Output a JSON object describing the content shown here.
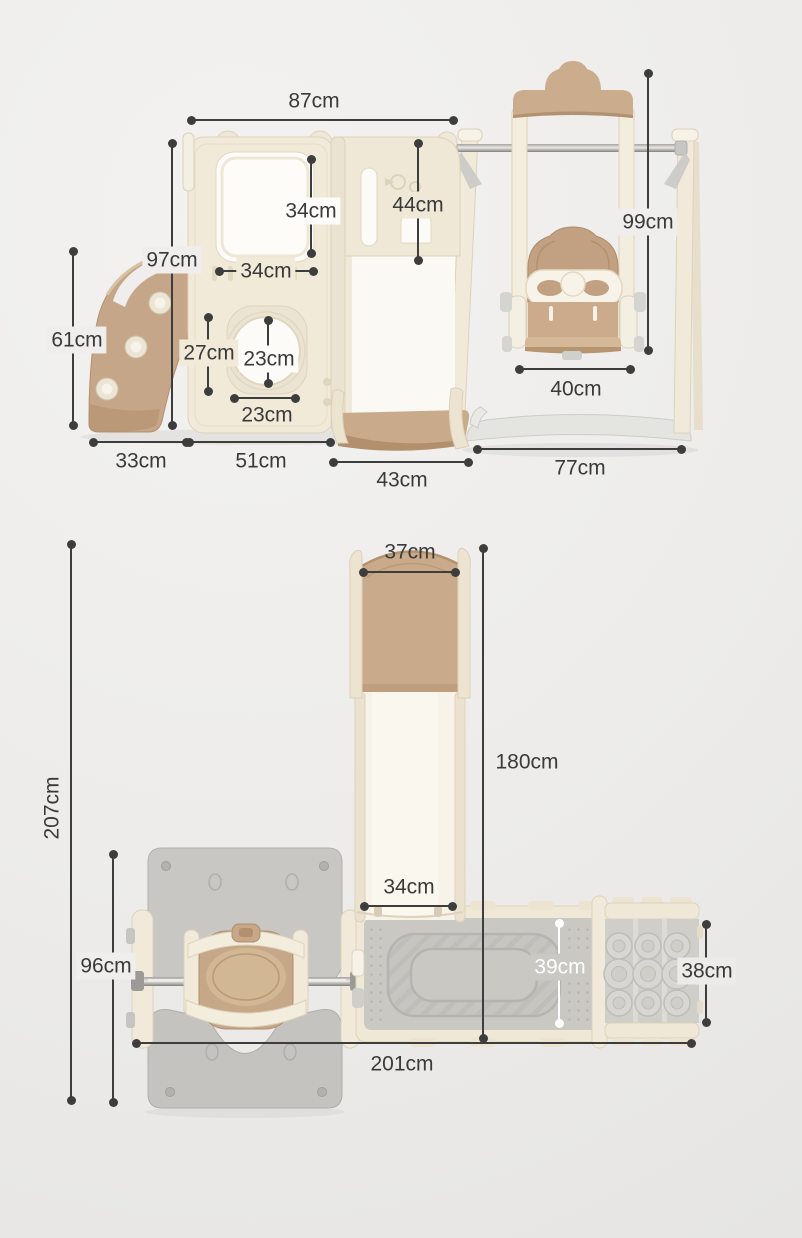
{
  "product": {
    "type": "kids-slide-swing-playset-dimension-diagram",
    "views": {
      "front": "front-view",
      "top": "top-view"
    }
  },
  "colors": {
    "background": "#efeeec",
    "cream": "#f1ead9",
    "tan": "#c7a98a",
    "gray_mat": "#c9c8c3",
    "gray_plate": "#c6c5c1",
    "dimension_line": "#3d3d3d",
    "dimension_line_white": "#ffffff",
    "text": "#3a3a3a"
  },
  "front_view": {
    "dimensions": [
      {
        "id": "house-top-width",
        "label": "87cm"
      },
      {
        "id": "house-height",
        "label": "97cm"
      },
      {
        "id": "slide-height",
        "label": "61cm"
      },
      {
        "id": "window-width",
        "label": "34cm"
      },
      {
        "id": "window-height",
        "label": "34cm"
      },
      {
        "id": "mid-panel-height",
        "label": "44cm"
      },
      {
        "id": "hole-top-offset",
        "label": "27cm"
      },
      {
        "id": "hole-height",
        "label": "23cm"
      },
      {
        "id": "hole-width",
        "label": "23cm"
      },
      {
        "id": "swing-height",
        "label": "99cm"
      },
      {
        "id": "swing-seat-width",
        "label": "40cm"
      },
      {
        "id": "slide-base-width",
        "label": "33cm"
      },
      {
        "id": "house-base-width",
        "label": "51cm"
      },
      {
        "id": "platform-width",
        "label": "43cm"
      },
      {
        "id": "swing-base-width",
        "label": "77cm"
      }
    ]
  },
  "top_view": {
    "dimensions": [
      {
        "id": "slide-top-width",
        "label": "37cm"
      },
      {
        "id": "slide-length",
        "label": "180cm"
      },
      {
        "id": "total-length",
        "label": "207cm"
      },
      {
        "id": "slide-end-width",
        "label": "34cm"
      },
      {
        "id": "swing-footprint-depth",
        "label": "96cm"
      },
      {
        "id": "mat-depth",
        "label": "39cm"
      },
      {
        "id": "climber-depth",
        "label": "38cm"
      },
      {
        "id": "total-width",
        "label": "201cm"
      }
    ]
  }
}
